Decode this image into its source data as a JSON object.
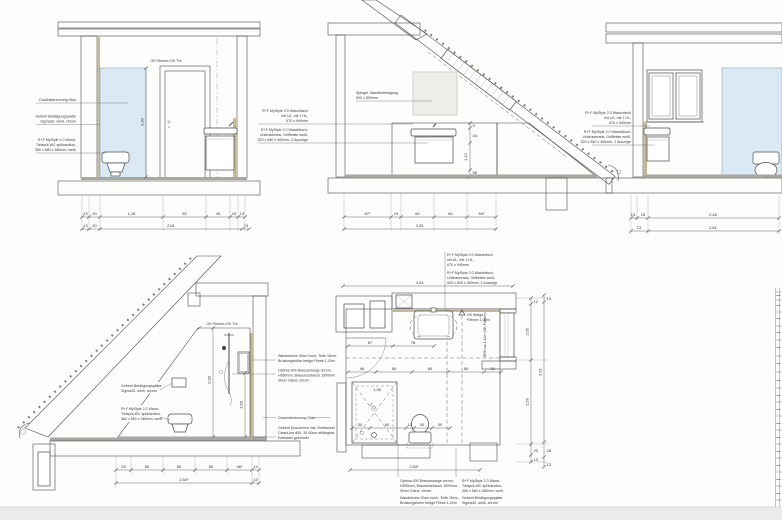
{
  "sheet": {
    "type": "architectural-bathroom-detail-drawing",
    "colors": {
      "paper": "#fdfdfc",
      "line": "#4c4c4c",
      "tile": "#d7cdb1",
      "tile_light": "#ddd5bc",
      "glass": "#dbe9f4",
      "mirror": "#eeeeea",
      "screed": "#a9a7a2",
      "paper_edge": "#ebebe9"
    }
  },
  "labels": {
    "ok": "OK Fliesen=OK Tür",
    "glas": "Duschabtrennung Glas",
    "bp": [
      "Geberit Betätigungsplatte",
      "Sigma30, weiß, chrom"
    ],
    "wc": [
      "R+F MyStyle 2.0 Wand-",
      "Tiefspül-WC spülrandlos,",
      "360 x 560 x 360mm, weiß"
    ],
    "wt": [
      "R+F MyStyle 2.0 Waschtisch",
      "mit UL, mit 1 HL,",
      "670 x 940mm"
    ],
    "us": [
      "R+F MyStyle 2.0 Waschtisch-",
      "Unterschrank, Griffleiste weiß,",
      "520 x 840 x 460mm, 2 Auszüge"
    ],
    "sp": [
      "Spiegel, Wandbefestigung",
      "800 x 800mm"
    ],
    "wn": [
      "Wandnische 30cm hoch, Tiefe 15cm,",
      "Brüstungshöhe fertige Fliese 1,20m"
    ],
    "bs": [
      "Optima 400 Brausestange chrom,",
      "H950mm, Brauseschlauch 1600mm",
      "Silver Glanz, chrom"
    ],
    "dr": [
      "Geberit Duschrinne inkl. Rohbauset",
      "CleanLine d50, 30-90cm ablängbar,",
      "Edelstahl gebürstet"
    ],
    "okf": [
      "OK fertige",
      "Fliesen 1,00m"
    ],
    "brh": "BRH ca.1,12m (OK Fliesen)"
  },
  "dims": {
    "a1": [
      "13",
      "20",
      "1,18",
      "80",
      "45",
      "15",
      "13"
    ],
    "a2": [
      "13",
      "20",
      "2,81",
      "13"
    ],
    "aH": "2,30",
    "b1": [
      "87*",
      "19",
      "60",
      "60",
      "54*"
    ],
    "b2": "2,81",
    "bV": [
      "9",
      "44",
      "1,12",
      "58"
    ],
    "c1": [
      "13",
      "15",
      "2,46"
    ],
    "c2": [
      "13",
      "2,61"
    ],
    "d1": [
      "28",
      "60",
      "60",
      "60",
      "46*",
      "13"
    ],
    "d2": [
      "2,54*",
      "13"
    ],
    "dH1": "2,00",
    "dH2": "1,58",
    "p_top": "2,81",
    "p1": [
      "87",
      "78"
    ],
    "p2": [
      "46",
      "60",
      "60",
      "60",
      "28"
    ],
    "p3": [
      "30",
      "60",
      "13",
      "30",
      "30"
    ],
    "pS": [
      "1,38",
      "1,21"
    ],
    "pRi": [
      "12",
      "1,05",
      "1,56",
      "20",
      "13"
    ],
    "pRo": [
      "13",
      "2,61",
      "28",
      "13"
    ],
    "p_bot": "2,54*"
  }
}
